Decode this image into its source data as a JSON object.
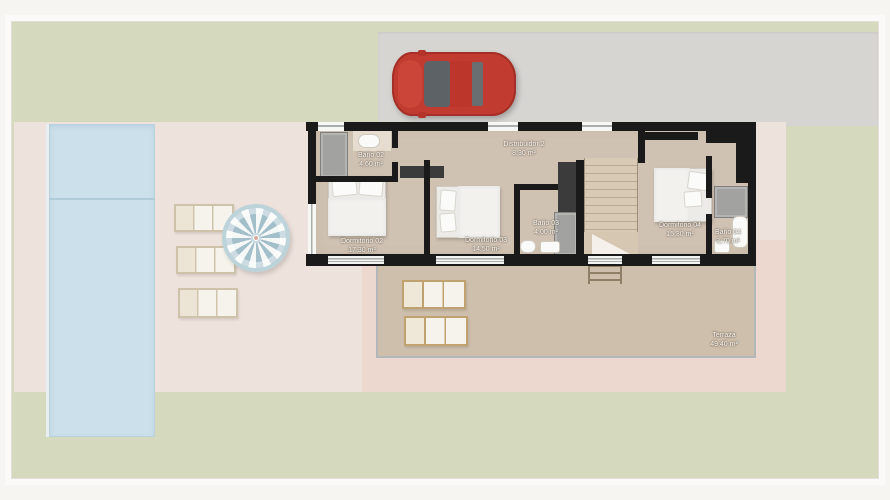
{
  "floorplan": {
    "rooms": [
      {
        "name": "Baño 02",
        "area": "4,60 m²"
      },
      {
        "name": "Dormitorio 02",
        "area": "17,30 m²"
      },
      {
        "name": "Distribuidor 2",
        "area": "8,30 m²"
      },
      {
        "name": "Dormitorio 03",
        "area": "14,50 m²"
      },
      {
        "name": "Baño 03",
        "area": "4,00 m²"
      },
      {
        "name": "Dormitorio 04",
        "area": "15,30 m²"
      },
      {
        "name": "Baño 04",
        "area": "3,70 m²"
      },
      {
        "name": "Terraza",
        "area": "49,40 m²"
      }
    ]
  },
  "site": {
    "objects": [
      "red-car",
      "swimming-pool",
      "parasol",
      "sun-loungers",
      "staircase",
      "terrace-ladder"
    ],
    "colors": {
      "grass": "#d5dabf",
      "driveway": "#d6d5d2",
      "pool": "#cbe0ea",
      "pool_deck": "#eee2dc",
      "terrace_floor": "#cdbfab",
      "terrace_frame": "#ecd8ce",
      "interior_floor": "#d0c2b2",
      "wall": "#1a1a1a",
      "car_body": "#c23b31",
      "parasol_stripe": "#a3bfca"
    }
  }
}
